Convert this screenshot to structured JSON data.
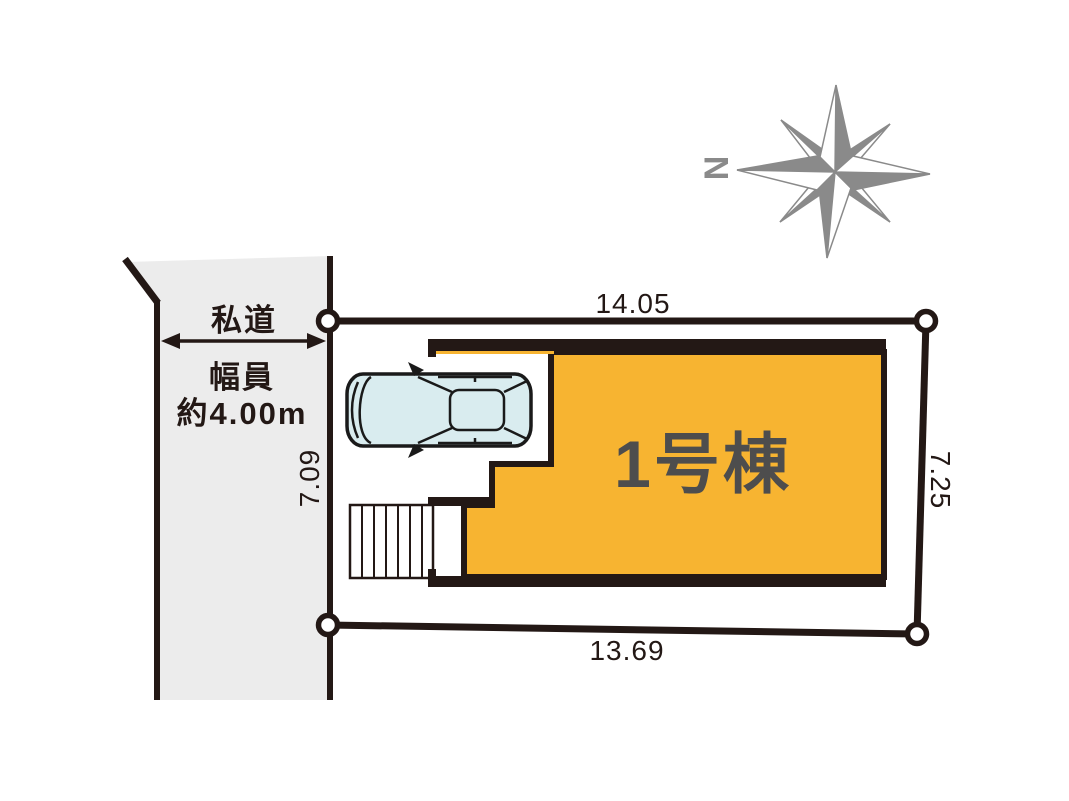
{
  "compass": {
    "north_label": "N"
  },
  "road": {
    "name": "私道",
    "width_label": "幅員",
    "width_value": "約4.00m",
    "side_dimension": "7.09"
  },
  "lot": {
    "top_dimension": "14.05",
    "right_dimension": "7.25",
    "bottom_dimension": "13.69"
  },
  "building": {
    "name": "1号棟"
  },
  "colors": {
    "building_fill": "#F7B431",
    "road_fill": "#ECECEC",
    "line": "#231815",
    "building_text": "#4D4D4D",
    "compass_gray": "#8A8A8A",
    "car_fill": "#D9ECEF"
  }
}
